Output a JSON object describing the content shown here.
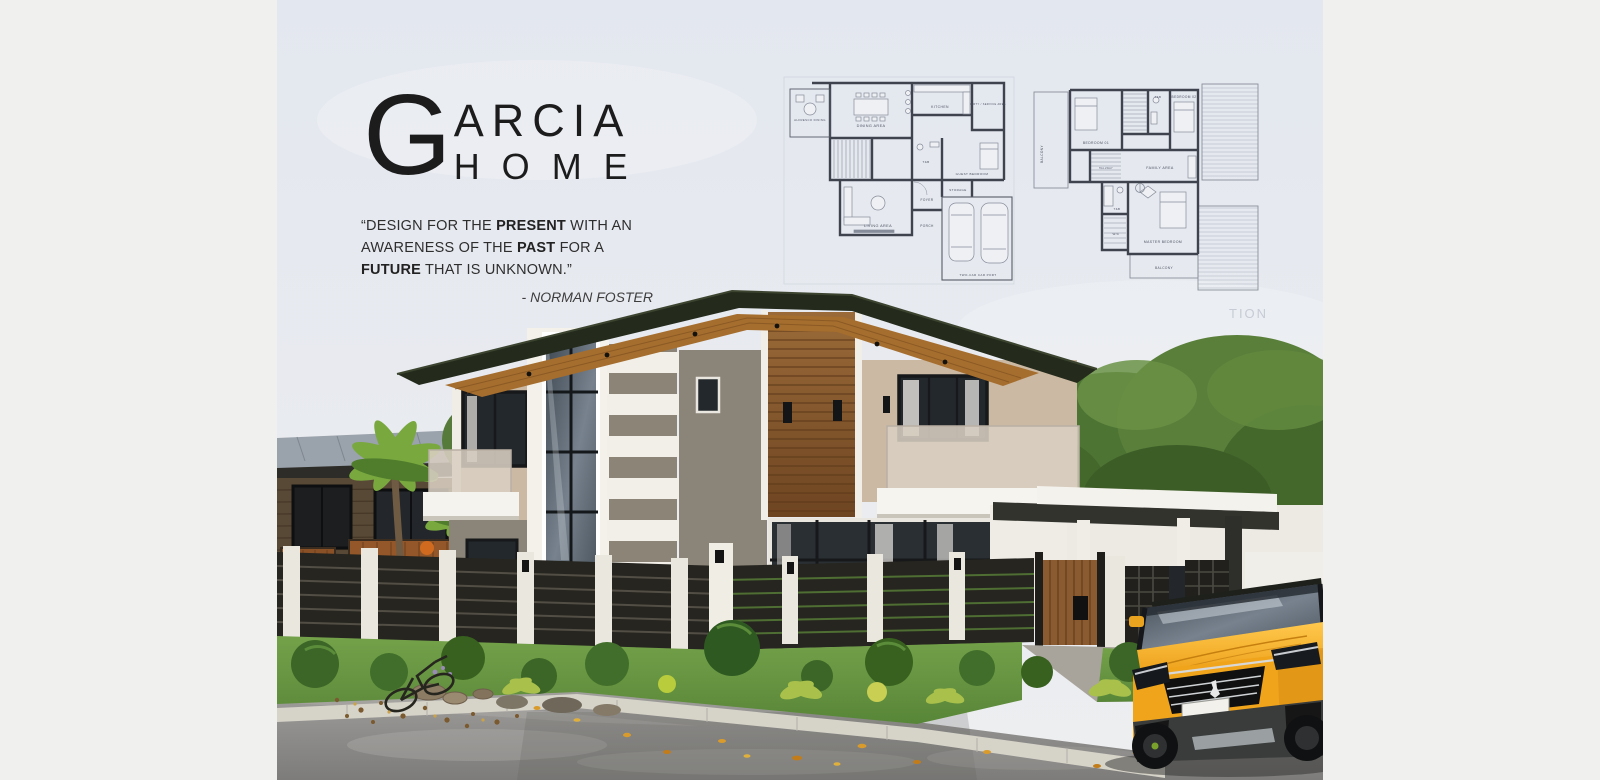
{
  "poster": {
    "brand": {
      "initial": "G",
      "line1": "ARCIA",
      "line2": "HOME"
    },
    "quote": {
      "open": "“DESIGN FOR THE ",
      "b1": "PRESENT",
      "m1": " WITH AN AWARENESS OF THE ",
      "b2": "PAST",
      "m2": " FOR A ",
      "b3": "FUTURE",
      "close": " THAT IS UNKNOWN.”",
      "attribution": "- NORMAN FOSTER"
    },
    "watermark": "TION",
    "plans": {
      "first_floor": {
        "alfresco": "ALFRESCO DINING",
        "dining": "DINING AREA",
        "kitchen": "KITCHEN",
        "dirty_service": "DIRTY / SERVICE AREA",
        "guest_bedroom": "GUEST BEDROOM",
        "toilet_bath": "T&B",
        "living": "LIVING AREA",
        "foyer": "FOYER",
        "storage": "STORAGE",
        "porch": "PORCH",
        "carport": "TWO-CAR CAR PORT"
      },
      "second_floor": {
        "balcony_side": "BALCONY",
        "bedroom_01": "BEDROOM 01",
        "toilet_bath_top": "T&B",
        "bedroom_02": "BEDROOM 02",
        "hallway": "HALLWAY",
        "family": "FAMILY AREA",
        "toilet_bath_master": "T&B",
        "walk_in_closet": "W/C",
        "master_bedroom": "MASTER BEDROOM",
        "balcony_bottom": "BALCONY"
      }
    },
    "colors": {
      "margin_bg": "#f0f0ee",
      "sky_top": "#e4e8f0",
      "roof_dark": "#242b1c",
      "soffit_wood": "#a56e2f",
      "accent_wood": "#8a5a30",
      "wall_white": "#f4f2ec",
      "wall_gray": "#8b8478",
      "wall_beige": "#ccb9a3",
      "glass_dark": "#252b2d",
      "fence_dark": "#26251f",
      "pillar_white": "#eae7df",
      "grass_green": "#699a43",
      "road_gray": "#8f8e8c",
      "curb_light": "#d6d3c9",
      "car_yellow": "#f0a41c",
      "plan_ink": "#3e434e"
    }
  }
}
